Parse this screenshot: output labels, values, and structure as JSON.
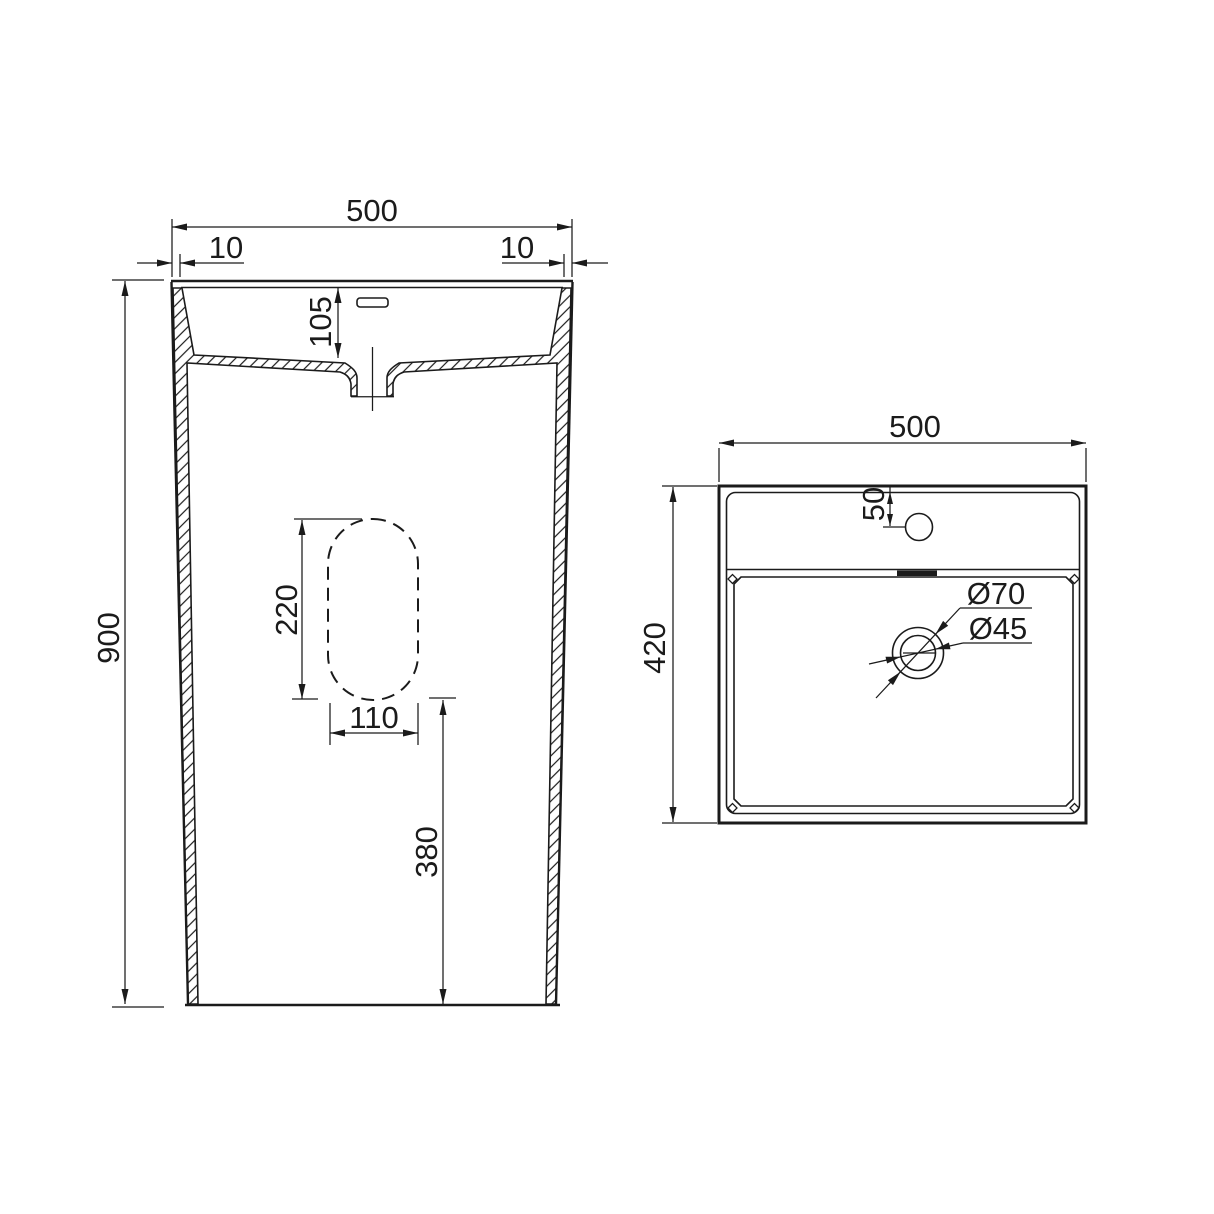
{
  "drawing": {
    "type": "technical-dimension-drawing",
    "subject": "pedestal-basin",
    "colors": {
      "line": "#1b1b1b",
      "background": "#ffffff"
    },
    "front_view": {
      "name": "front section view",
      "dims": {
        "overall_width": "500",
        "wall_left": "10",
        "wall_right": "10",
        "basin_depth": "105",
        "overall_height": "900",
        "cutout_height": "220",
        "cutout_width": "110",
        "cutout_elevation": "380"
      }
    },
    "top_view": {
      "name": "top plan view",
      "dims": {
        "overall_width": "500",
        "overall_depth": "420",
        "faucet_offset": "50",
        "drain_outer_dia": "Ø70",
        "drain_inner_dia": "Ø45"
      }
    }
  }
}
